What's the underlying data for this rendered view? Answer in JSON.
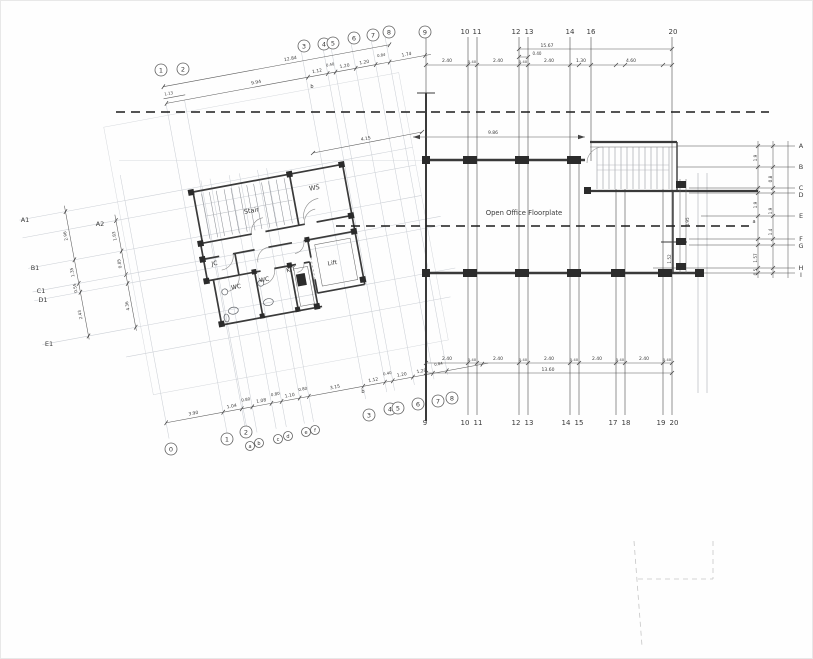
{
  "rooms": {
    "stair": "Stair",
    "ws": "WS",
    "jc": "JC",
    "wc1": "WC",
    "wc2": "WC",
    "kit": "KIT",
    "lift": "Lift",
    "office": "Open Office Floorplate"
  },
  "grids": {
    "top_circled": [
      "1",
      "2",
      "3",
      "4",
      "5",
      "6",
      "7",
      "8",
      "9"
    ],
    "top_plain": [
      "10",
      "11",
      "12",
      "13",
      "14",
      "16",
      "20"
    ],
    "bottom_plain": [
      "9",
      "10",
      "11",
      "12",
      "13",
      "14",
      "15",
      "17",
      "18",
      "19",
      "20"
    ],
    "bottom_circled": [
      "0",
      "1",
      "2",
      "a",
      "b",
      "c",
      "d",
      "e",
      "f",
      "3",
      "4",
      "5",
      "6",
      "7",
      "8"
    ],
    "left": [
      "A1",
      "A2",
      "B1",
      "C1",
      "D1",
      "E1"
    ],
    "right": [
      "A",
      "B",
      "C",
      "D",
      "E",
      "F",
      "G",
      "H",
      "I"
    ],
    "markers": {
      "b_top": "b",
      "b_bottom": "b",
      "a_mid": "a"
    }
  },
  "dims": {
    "top_left": [
      "12.84",
      "9.94",
      "1.13",
      "1.12",
      "0.40",
      "1.20",
      "1.20",
      "0.84",
      "1.74"
    ],
    "top_right": [
      "15.67",
      "0.40",
      "2.40",
      "0.40",
      "2.40",
      "0.40",
      "2.40",
      "1.30",
      "4.60"
    ],
    "office_depth": "9.86",
    "diagonal": "4.15",
    "bottom_right": [
      "2.40",
      "0.40",
      "2.40",
      "0.40",
      "2.40",
      "0.40",
      "2.40",
      "0.40",
      "2.40",
      "0.40",
      "13.60"
    ],
    "bottom_left": [
      "3.90",
      "1.04",
      "0.80",
      "1.08",
      "0.80",
      "1.10",
      "0.80",
      "3.15",
      "1.12",
      "0.40",
      "1.20",
      "1.20",
      "0.84"
    ],
    "left_side": [
      "2.96",
      "1.35",
      "0.55",
      "2.43",
      "1.83",
      "0.85",
      "4.36"
    ],
    "right_side": [
      "1.9",
      "0.8",
      "1.9",
      "1.9",
      "1.4",
      "1.57",
      "0.5"
    ],
    "lift_side": [
      "4.95",
      "1.52"
    ]
  }
}
